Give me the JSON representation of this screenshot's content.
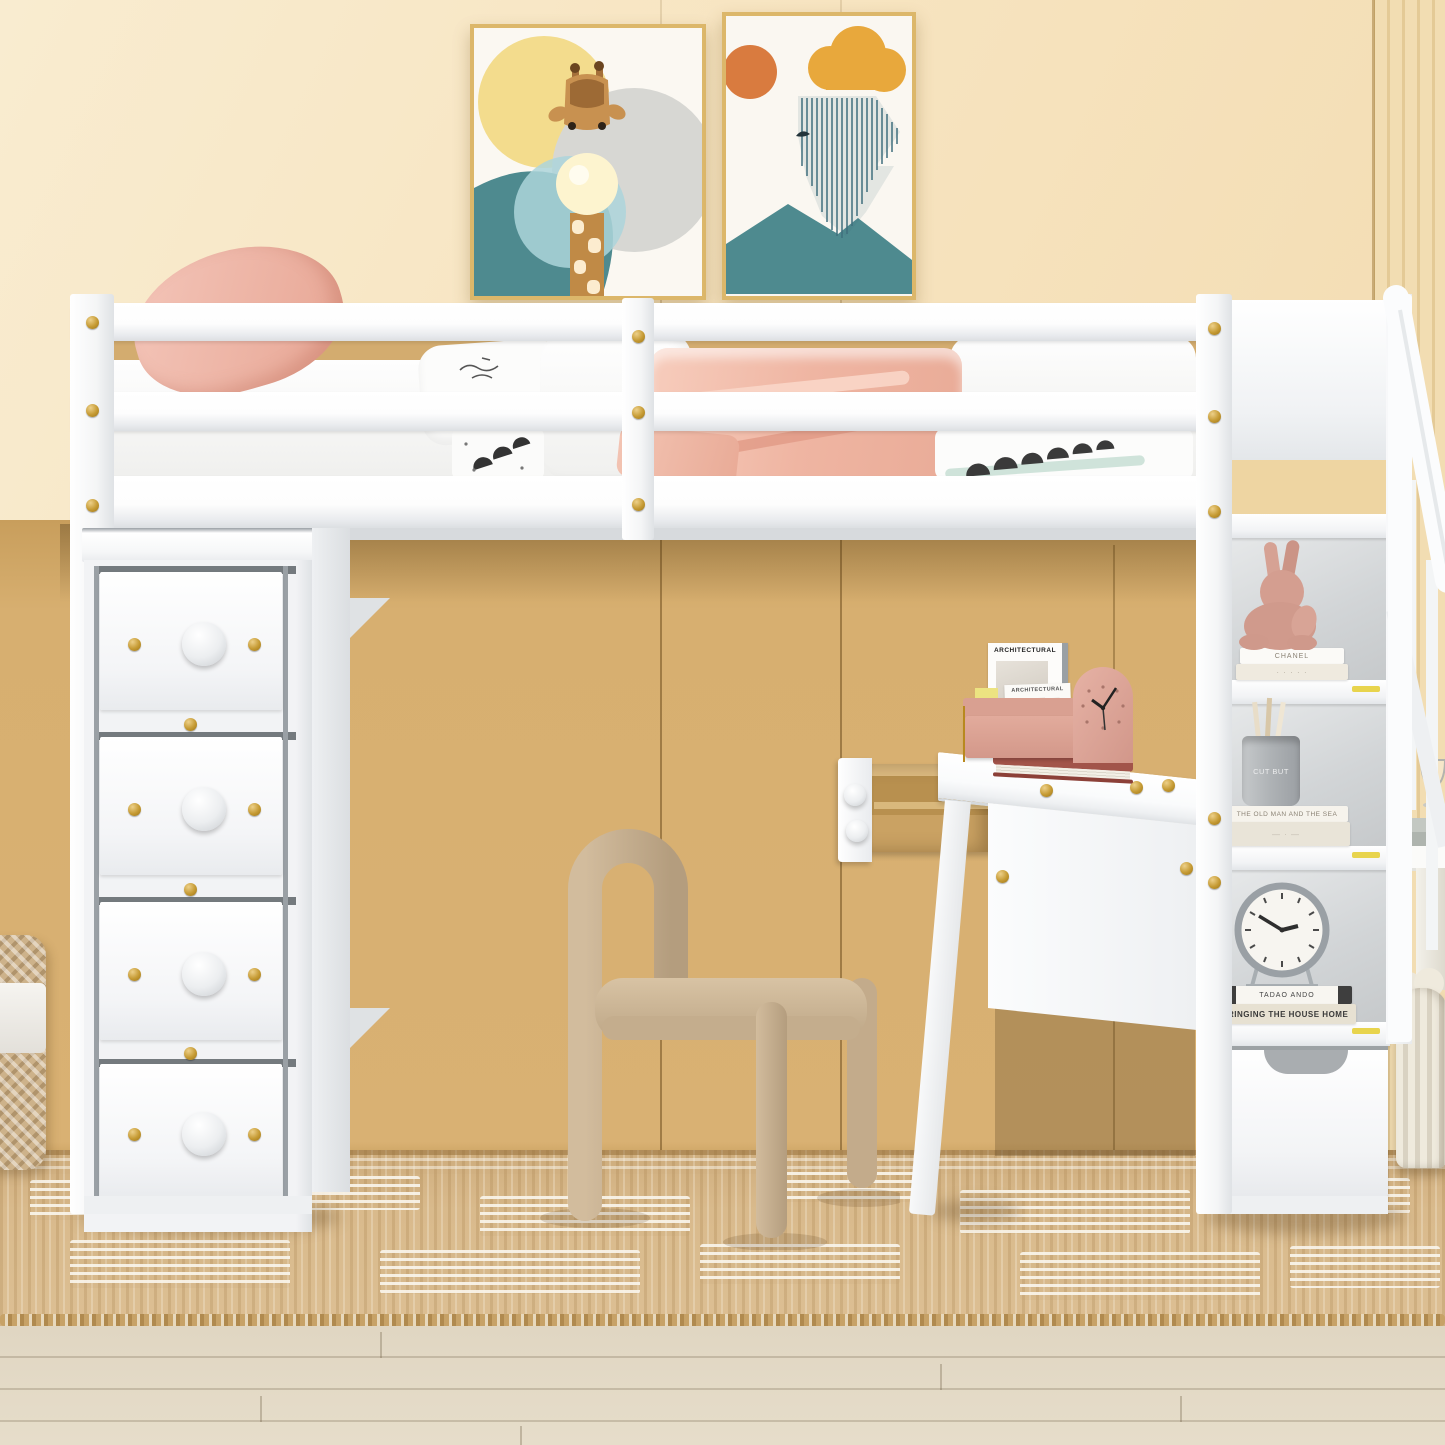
{
  "scene": {
    "description": "Product photo of a kids bedroom: white twin loft bed with staircase storage shelves, 4-drawer chest, built-in desk with pulled-out drawer, beige arch chair, jute rug on light wood floor",
    "palette": {
      "wall": "#f6e2bc",
      "wardrobe": "#d9b173",
      "furniture_white": "#ffffff",
      "hardware_gold": "#c59a33",
      "pillow_pink": "#f2c0b4",
      "blanket_pink": "#efb5a2",
      "chair_beige": "#c6af90",
      "rug": "#d9ba8c",
      "floor": "#e4dbc8",
      "accent_teal": "#4e8a8f",
      "accent_pink": "#dfa79c"
    }
  },
  "artwork": {
    "left_print": {
      "subject": "giraffe blowing a bubble among sun and circles"
    },
    "right_print": {
      "subject": "abstract landscape with sun, cloud, striped chevrons and teal mountains"
    }
  },
  "desk": {
    "items": {
      "magazine_title": "ARCHITECTURAL",
      "card_title": "ARCHITECTURAL"
    }
  },
  "shelves": {
    "book_spine_chanel": "CHANEL",
    "book_spine_old_man": "THE OLD MAN AND THE SEA",
    "jar_label": "CUT BUT",
    "book_spine_tadao": "TADAO ANDO",
    "book_spine_bringing": "BRINGING THE HOUSE HOME"
  }
}
